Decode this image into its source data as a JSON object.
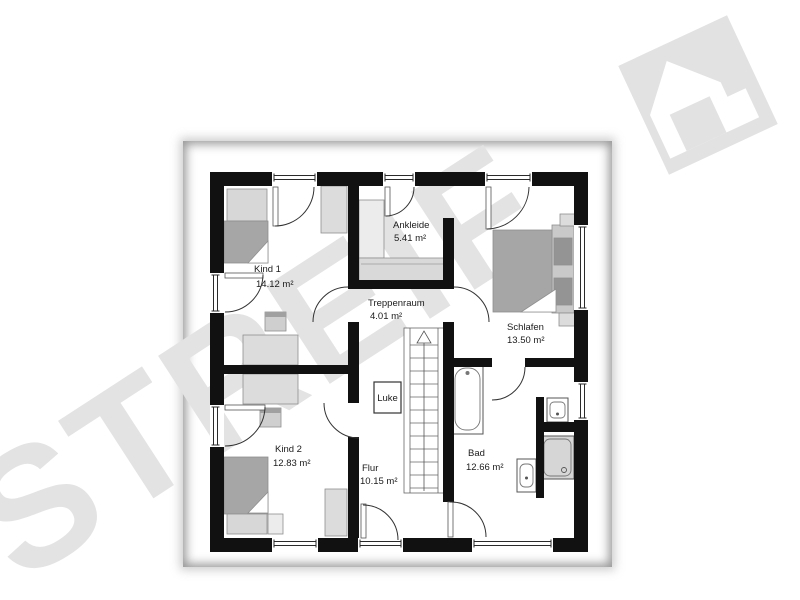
{
  "watermark": {
    "text": "STREIF",
    "color": "#e3e3e3"
  },
  "icons": {
    "logo": "streif-house-logo"
  },
  "rooms": {
    "kind1": {
      "name": "Kind 1",
      "area": "14.12 m²"
    },
    "ankleide": {
      "name": "Ankleide",
      "area": "5.41 m²"
    },
    "treppenraum": {
      "name": "Treppenraum",
      "area": "4.01 m²"
    },
    "schlafen": {
      "name": "Schlafen",
      "area": "13.50 m²"
    },
    "kind2": {
      "name": "Kind 2",
      "area": "12.83 m²"
    },
    "flur": {
      "name": "Flur",
      "area": "10.15 m²"
    },
    "bad": {
      "name": "Bad",
      "area": "12.66 m²"
    }
  },
  "annotations": {
    "hatch": "Luke"
  },
  "colors": {
    "wall": "#111111",
    "watermark": "#e3e3e3",
    "furniture_light": "#dcdcdc",
    "bed": "#a6a6a6",
    "logo": "#e2e2e2"
  }
}
